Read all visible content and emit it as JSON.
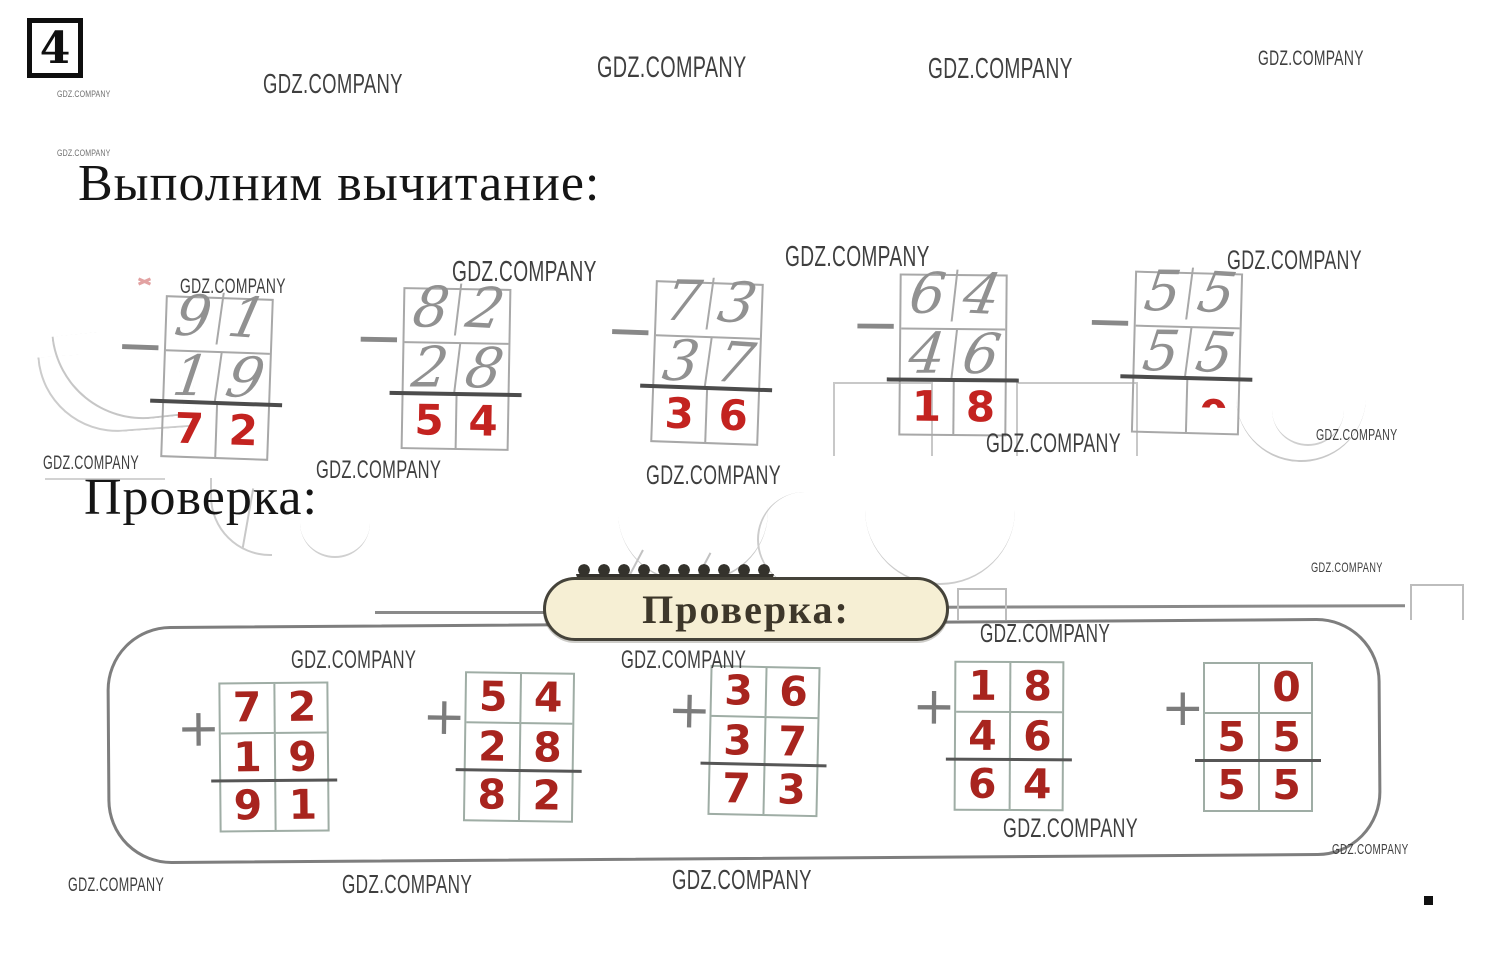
{
  "page": {
    "problem_number": "4"
  },
  "watermark": {
    "text": "GDZ.COMPANY"
  },
  "headings": {
    "subtraction": "Выполним вычитание:",
    "check": "Проверка:"
  },
  "badge": {
    "label": "Проверка:"
  },
  "subtraction": {
    "operator": "−",
    "problems": [
      {
        "minuend": [
          "9",
          "1"
        ],
        "subtrahend": [
          "1",
          "9"
        ],
        "result": [
          "7",
          "2"
        ]
      },
      {
        "minuend": [
          "8",
          "2"
        ],
        "subtrahend": [
          "2",
          "8"
        ],
        "result": [
          "5",
          "4"
        ]
      },
      {
        "minuend": [
          "7",
          "3"
        ],
        "subtrahend": [
          "3",
          "7"
        ],
        "result": [
          "3",
          "6"
        ]
      },
      {
        "minuend": [
          "6",
          "4"
        ],
        "subtrahend": [
          "4",
          "6"
        ],
        "result": [
          "1",
          "8"
        ]
      },
      {
        "minuend": [
          "5",
          "5"
        ],
        "subtrahend": [
          "5",
          "5"
        ],
        "result": [
          "",
          "0"
        ]
      }
    ]
  },
  "check": {
    "operator": "+",
    "problems": [
      {
        "addend1": [
          "7",
          "2"
        ],
        "addend2": [
          "1",
          "9"
        ],
        "sum": [
          "9",
          "1"
        ]
      },
      {
        "addend1": [
          "5",
          "4"
        ],
        "addend2": [
          "2",
          "8"
        ],
        "sum": [
          "8",
          "2"
        ]
      },
      {
        "addend1": [
          "3",
          "6"
        ],
        "addend2": [
          "3",
          "7"
        ],
        "sum": [
          "7",
          "3"
        ]
      },
      {
        "addend1": [
          "1",
          "8"
        ],
        "addend2": [
          "4",
          "6"
        ],
        "sum": [
          "6",
          "4"
        ]
      },
      {
        "addend1": [
          "",
          "0"
        ],
        "addend2": [
          "5",
          "5"
        ],
        "sum": [
          "5",
          "5"
        ]
      }
    ]
  },
  "colors": {
    "subtraction_answer_red": "#c32320",
    "check_digit_red": "#a8241e",
    "pencil_gray": "#919191",
    "badge_background": "#f6efd4",
    "badge_border": "#45433a",
    "box_border": "#7e7e7e"
  }
}
